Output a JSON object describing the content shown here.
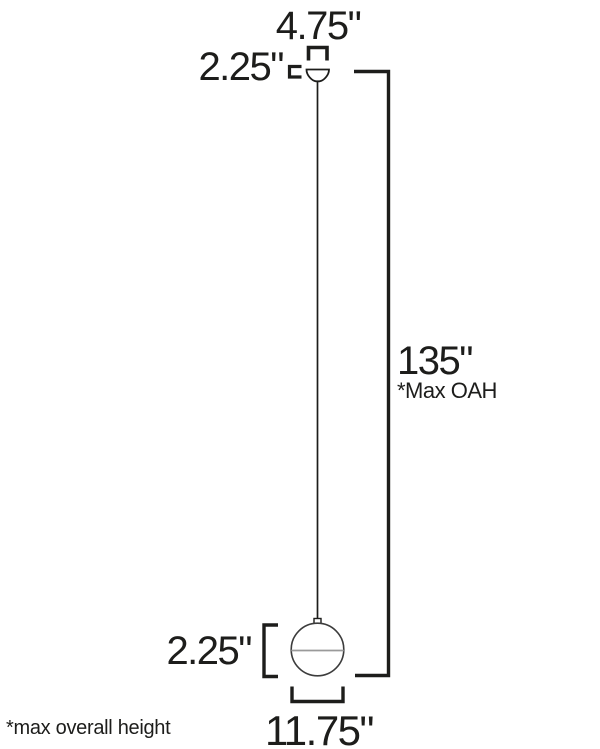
{
  "diagram": {
    "type": "pendant-light-dimension-drawing",
    "labels": {
      "canopy_width": "4.75\"",
      "canopy_height": "2.25\"",
      "max_height": "135\"",
      "max_height_note": "*Max OAH",
      "fixture_height": "2.25\"",
      "fixture_width": "11.75\"",
      "footnote": "*max overall height"
    },
    "colors": {
      "line": "#1d1d1b",
      "sphere_outline": "#3c3c3c",
      "band": "#9a9a9a",
      "background": "#ffffff"
    }
  }
}
